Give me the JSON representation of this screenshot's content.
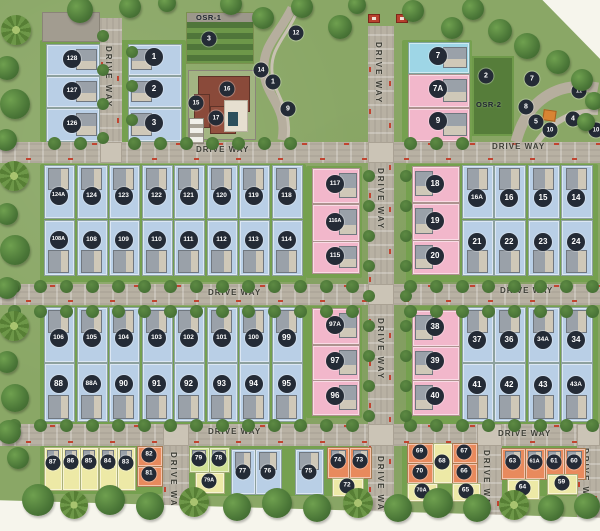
{
  "map": {
    "driveway_label": "DRIVE WAY",
    "osr1_label": "OSR-1",
    "osr2_label": "OSR-2",
    "driveways": {
      "horizontal": [
        {
          "x": 0,
          "y": 142,
          "w": 600,
          "h": 21
        },
        {
          "x": 0,
          "y": 284,
          "w": 600,
          "h": 21
        },
        {
          "x": 0,
          "y": 424,
          "w": 600,
          "h": 22
        }
      ],
      "vertical": [
        {
          "x": 100,
          "y": 18,
          "w": 22,
          "h": 125
        },
        {
          "x": 368,
          "y": 26,
          "w": 26,
          "h": 500
        },
        {
          "x": 163,
          "y": 446,
          "w": 26,
          "h": 80
        },
        {
          "x": 477,
          "y": 446,
          "w": 25,
          "h": 80
        },
        {
          "x": 577,
          "y": 446,
          "w": 23,
          "h": 75
        }
      ],
      "labels": [
        {
          "x": 196,
          "y": 145,
          "v": 0
        },
        {
          "x": 492,
          "y": 142,
          "v": 0
        },
        {
          "x": 208,
          "y": 288,
          "v": 0
        },
        {
          "x": 500,
          "y": 286,
          "v": 0
        },
        {
          "x": 208,
          "y": 427,
          "v": 0
        },
        {
          "x": 498,
          "y": 429,
          "v": 0
        },
        {
          "x": 104,
          "y": 46,
          "v": 1
        },
        {
          "x": 374,
          "y": 42,
          "v": 1
        },
        {
          "x": 376,
          "y": 168,
          "v": 1
        },
        {
          "x": 376,
          "y": 318,
          "v": 1
        },
        {
          "x": 376,
          "y": 456,
          "v": 1
        },
        {
          "x": 169,
          "y": 452,
          "v": 1
        },
        {
          "x": 482,
          "y": 450,
          "v": 1
        },
        {
          "x": 581,
          "y": 448,
          "v": 1
        }
      ]
    }
  },
  "palette": {
    "blue": "#b9cfe6",
    "cyan": "#9ed6e6",
    "pink": "#f2b7cb",
    "yellow": "#ede9a6",
    "orange": "#e88a5d",
    "green": "#cfe093",
    "circle": "#242b36",
    "road": "#b8b1a3",
    "lawn": "#567d3a",
    "red": "#c04531"
  },
  "plots": [
    {
      "label": "128",
      "x": 46,
      "y": 44,
      "w": 52,
      "h": 30,
      "c": "blue",
      "hs": "r",
      "cy": 59
    },
    {
      "label": "127",
      "x": 46,
      "y": 76,
      "w": 52,
      "h": 30,
      "c": "blue",
      "hs": "r",
      "cy": 91
    },
    {
      "label": "126",
      "x": 46,
      "y": 108,
      "w": 52,
      "h": 32,
      "c": "blue",
      "hs": "r",
      "cy": 124
    },
    {
      "label": "1",
      "x": 128,
      "y": 44,
      "w": 52,
      "h": 30,
      "c": "blue",
      "hs": "l",
      "cy": 57
    },
    {
      "label": "2",
      "x": 128,
      "y": 76,
      "w": 52,
      "h": 30,
      "c": "blue",
      "hs": "l",
      "cy": 89
    },
    {
      "label": "3",
      "x": 128,
      "y": 108,
      "w": 52,
      "h": 32,
      "c": "blue",
      "hs": "l",
      "cy": 123
    },
    {
      "label": "7",
      "x": 408,
      "y": 42,
      "w": 60,
      "h": 30,
      "c": "cyan",
      "hs": "r",
      "cy": 56
    },
    {
      "label": "7A",
      "x": 408,
      "y": 74,
      "w": 60,
      "h": 32,
      "c": "pink",
      "hs": "r",
      "cy": 89
    },
    {
      "label": "9",
      "x": 408,
      "y": 108,
      "w": 60,
      "h": 32,
      "c": "pink",
      "hs": "r",
      "cy": 121
    },
    {
      "label": "124A",
      "x": 44,
      "y": 165,
      "w": 29,
      "h": 52,
      "c": "blue",
      "hs": "t",
      "cy": 196
    },
    {
      "label": "124",
      "x": 77,
      "y": 165,
      "w": 29,
      "h": 52,
      "c": "blue",
      "hs": "t",
      "cy": 196
    },
    {
      "label": "123",
      "x": 109,
      "y": 165,
      "w": 29,
      "h": 52,
      "c": "blue",
      "hs": "t",
      "cy": 196
    },
    {
      "label": "122",
      "x": 142,
      "y": 165,
      "w": 29,
      "h": 52,
      "c": "blue",
      "hs": "t",
      "cy": 196
    },
    {
      "label": "121",
      "x": 174,
      "y": 165,
      "w": 29,
      "h": 52,
      "c": "blue",
      "hs": "t",
      "cy": 196
    },
    {
      "label": "120",
      "x": 207,
      "y": 165,
      "w": 29,
      "h": 52,
      "c": "blue",
      "hs": "t",
      "cy": 196
    },
    {
      "label": "119",
      "x": 239,
      "y": 165,
      "w": 29,
      "h": 52,
      "c": "blue",
      "hs": "t",
      "cy": 196
    },
    {
      "label": "118",
      "x": 272,
      "y": 165,
      "w": 29,
      "h": 52,
      "c": "blue",
      "hs": "t",
      "cy": 196
    },
    {
      "label": "108A",
      "x": 44,
      "y": 220,
      "w": 29,
      "h": 54,
      "c": "blue",
      "hs": "b",
      "cy": 240
    },
    {
      "label": "108",
      "x": 77,
      "y": 220,
      "w": 29,
      "h": 54,
      "c": "blue",
      "hs": "b",
      "cy": 240
    },
    {
      "label": "109",
      "x": 109,
      "y": 220,
      "w": 29,
      "h": 54,
      "c": "blue",
      "hs": "b",
      "cy": 240
    },
    {
      "label": "110",
      "x": 142,
      "y": 220,
      "w": 29,
      "h": 54,
      "c": "blue",
      "hs": "b",
      "cy": 240
    },
    {
      "label": "111",
      "x": 174,
      "y": 220,
      "w": 29,
      "h": 54,
      "c": "blue",
      "hs": "b",
      "cy": 240
    },
    {
      "label": "112",
      "x": 207,
      "y": 220,
      "w": 29,
      "h": 54,
      "c": "blue",
      "hs": "b",
      "cy": 240
    },
    {
      "label": "113",
      "x": 239,
      "y": 220,
      "w": 29,
      "h": 54,
      "c": "blue",
      "hs": "b",
      "cy": 240
    },
    {
      "label": "114",
      "x": 272,
      "y": 220,
      "w": 29,
      "h": 54,
      "c": "blue",
      "hs": "b",
      "cy": 240
    },
    {
      "label": "117",
      "x": 312,
      "y": 168,
      "w": 46,
      "h": 34,
      "c": "pink",
      "hs": "r",
      "cy": 184
    },
    {
      "label": "116A",
      "x": 312,
      "y": 204,
      "w": 46,
      "h": 36,
      "c": "pink",
      "hs": "r",
      "cy": 222
    },
    {
      "label": "115",
      "x": 312,
      "y": 241,
      "w": 46,
      "h": 31,
      "c": "pink",
      "hs": "r",
      "cy": 256
    },
    {
      "label": "18",
      "x": 412,
      "y": 166,
      "w": 46,
      "h": 35,
      "c": "pink",
      "hs": "l",
      "cy": 184
    },
    {
      "label": "19",
      "x": 412,
      "y": 203,
      "w": 46,
      "h": 36,
      "c": "pink",
      "hs": "l",
      "cy": 221
    },
    {
      "label": "20",
      "x": 412,
      "y": 240,
      "w": 46,
      "h": 33,
      "c": "pink",
      "hs": "l",
      "cy": 256
    },
    {
      "label": "16A",
      "x": 462,
      "y": 165,
      "w": 30,
      "h": 52,
      "c": "blue",
      "hs": "t",
      "cy": 198
    },
    {
      "label": "16",
      "x": 494,
      "y": 165,
      "w": 30,
      "h": 52,
      "c": "blue",
      "hs": "t",
      "cy": 198
    },
    {
      "label": "15",
      "x": 528,
      "y": 165,
      "w": 30,
      "h": 52,
      "c": "blue",
      "hs": "t",
      "cy": 198
    },
    {
      "label": "14",
      "x": 561,
      "y": 165,
      "w": 30,
      "h": 52,
      "c": "blue",
      "hs": "t",
      "cy": 198
    },
    {
      "label": "21",
      "x": 462,
      "y": 220,
      "w": 30,
      "h": 54,
      "c": "blue",
      "hs": "b",
      "cy": 242
    },
    {
      "label": "22",
      "x": 494,
      "y": 220,
      "w": 30,
      "h": 54,
      "c": "blue",
      "hs": "b",
      "cy": 242
    },
    {
      "label": "23",
      "x": 528,
      "y": 220,
      "w": 30,
      "h": 54,
      "c": "blue",
      "hs": "b",
      "cy": 242
    },
    {
      "label": "24",
      "x": 561,
      "y": 220,
      "w": 30,
      "h": 54,
      "c": "blue",
      "hs": "b",
      "cy": 242
    },
    {
      "label": "106",
      "x": 44,
      "y": 307,
      "w": 29,
      "h": 54,
      "c": "blue",
      "hs": "t",
      "cy": 338
    },
    {
      "label": "105",
      "x": 77,
      "y": 307,
      "w": 29,
      "h": 54,
      "c": "blue",
      "hs": "t",
      "cy": 338
    },
    {
      "label": "104",
      "x": 109,
      "y": 307,
      "w": 29,
      "h": 54,
      "c": "blue",
      "hs": "t",
      "cy": 338
    },
    {
      "label": "103",
      "x": 142,
      "y": 307,
      "w": 29,
      "h": 54,
      "c": "blue",
      "hs": "t",
      "cy": 338
    },
    {
      "label": "102",
      "x": 174,
      "y": 307,
      "w": 29,
      "h": 54,
      "c": "blue",
      "hs": "t",
      "cy": 338
    },
    {
      "label": "101",
      "x": 207,
      "y": 307,
      "w": 29,
      "h": 54,
      "c": "blue",
      "hs": "t",
      "cy": 338
    },
    {
      "label": "100",
      "x": 239,
      "y": 307,
      "w": 29,
      "h": 54,
      "c": "blue",
      "hs": "t",
      "cy": 338
    },
    {
      "label": "99",
      "x": 272,
      "y": 307,
      "w": 29,
      "h": 54,
      "c": "blue",
      "hs": "t",
      "cy": 338
    },
    {
      "label": "88",
      "x": 44,
      "y": 363,
      "w": 29,
      "h": 57,
      "c": "blue",
      "hs": "b",
      "cy": 384
    },
    {
      "label": "88A",
      "x": 77,
      "y": 363,
      "w": 29,
      "h": 57,
      "c": "blue",
      "hs": "b",
      "cy": 384
    },
    {
      "label": "90",
      "x": 109,
      "y": 363,
      "w": 29,
      "h": 57,
      "c": "blue",
      "hs": "b",
      "cy": 384
    },
    {
      "label": "91",
      "x": 142,
      "y": 363,
      "w": 29,
      "h": 57,
      "c": "blue",
      "hs": "b",
      "cy": 384
    },
    {
      "label": "92",
      "x": 174,
      "y": 363,
      "w": 29,
      "h": 57,
      "c": "blue",
      "hs": "b",
      "cy": 384
    },
    {
      "label": "93",
      "x": 207,
      "y": 363,
      "w": 29,
      "h": 57,
      "c": "blue",
      "hs": "b",
      "cy": 384
    },
    {
      "label": "94",
      "x": 239,
      "y": 363,
      "w": 29,
      "h": 57,
      "c": "blue",
      "hs": "b",
      "cy": 384
    },
    {
      "label": "95",
      "x": 272,
      "y": 363,
      "w": 29,
      "h": 57,
      "c": "blue",
      "hs": "b",
      "cy": 384
    },
    {
      "label": "97A",
      "x": 312,
      "y": 308,
      "w": 46,
      "h": 35,
      "c": "pink",
      "hs": "r",
      "cy": 325
    },
    {
      "label": "97",
      "x": 312,
      "y": 345,
      "w": 46,
      "h": 34,
      "c": "pink",
      "hs": "r",
      "cy": 361
    },
    {
      "label": "96",
      "x": 312,
      "y": 380,
      "w": 46,
      "h": 34,
      "c": "pink",
      "hs": "r",
      "cy": 396
    },
    {
      "label": "38",
      "x": 412,
      "y": 310,
      "w": 46,
      "h": 35,
      "c": "pink",
      "hs": "l",
      "cy": 327
    },
    {
      "label": "39",
      "x": 412,
      "y": 346,
      "w": 46,
      "h": 33,
      "c": "pink",
      "hs": "l",
      "cy": 361
    },
    {
      "label": "40",
      "x": 412,
      "y": 380,
      "w": 46,
      "h": 34,
      "c": "pink",
      "hs": "l",
      "cy": 396
    },
    {
      "label": "37",
      "x": 462,
      "y": 307,
      "w": 30,
      "h": 54,
      "c": "blue",
      "hs": "t",
      "cy": 340
    },
    {
      "label": "36",
      "x": 494,
      "y": 307,
      "w": 30,
      "h": 54,
      "c": "blue",
      "hs": "t",
      "cy": 340
    },
    {
      "label": "34A",
      "x": 528,
      "y": 307,
      "w": 30,
      "h": 54,
      "c": "blue",
      "hs": "t",
      "cy": 340
    },
    {
      "label": "34",
      "x": 561,
      "y": 307,
      "w": 30,
      "h": 54,
      "c": "blue",
      "hs": "t",
      "cy": 340
    },
    {
      "label": "41",
      "x": 462,
      "y": 363,
      "w": 30,
      "h": 57,
      "c": "blue",
      "hs": "b",
      "cy": 385
    },
    {
      "label": "42",
      "x": 494,
      "y": 363,
      "w": 30,
      "h": 57,
      "c": "blue",
      "hs": "b",
      "cy": 385
    },
    {
      "label": "43",
      "x": 528,
      "y": 363,
      "w": 30,
      "h": 57,
      "c": "blue",
      "hs": "b",
      "cy": 385
    },
    {
      "label": "43A",
      "x": 561,
      "y": 363,
      "w": 30,
      "h": 57,
      "c": "blue",
      "hs": "b",
      "cy": 385
    },
    {
      "label": "87",
      "x": 44,
      "y": 447,
      "w": 17,
      "h": 42,
      "c": "yellow",
      "hs": "t",
      "cy": 463,
      "s": 1
    },
    {
      "label": "86",
      "x": 62,
      "y": 447,
      "w": 17,
      "h": 42,
      "c": "yellow",
      "hs": "t",
      "cy": 462,
      "s": 1
    },
    {
      "label": "85",
      "x": 80,
      "y": 447,
      "w": 17,
      "h": 42,
      "c": "yellow",
      "hs": "t",
      "cy": 462,
      "s": 1
    },
    {
      "label": "84",
      "x": 99,
      "y": 447,
      "w": 17,
      "h": 42,
      "c": "yellow",
      "hs": "t",
      "cy": 462,
      "s": 1
    },
    {
      "label": "83",
      "x": 117,
      "y": 447,
      "w": 17,
      "h": 42,
      "c": "yellow",
      "hs": "t",
      "cy": 463,
      "s": 1
    },
    {
      "label": "82",
      "x": 137,
      "y": 446,
      "w": 24,
      "h": 19,
      "c": "orange",
      "hs": "n",
      "cy": 455,
      "s": 1
    },
    {
      "label": "81",
      "x": 137,
      "y": 466,
      "w": 24,
      "h": 19,
      "c": "orange",
      "hs": "n",
      "cy": 474,
      "s": 1
    },
    {
      "label": "79",
      "x": 189,
      "y": 447,
      "w": 19,
      "h": 24,
      "c": "green",
      "hs": "t",
      "cy": 459,
      "s": 1
    },
    {
      "label": "78",
      "x": 209,
      "y": 447,
      "w": 19,
      "h": 24,
      "c": "green",
      "hs": "t",
      "cy": 459,
      "s": 1
    },
    {
      "label": "79A",
      "x": 195,
      "y": 472,
      "w": 28,
      "h": 20,
      "c": "yellow",
      "hs": "n",
      "cy": 481,
      "s": 1
    },
    {
      "label": "77",
      "x": 231,
      "y": 449,
      "w": 23,
      "h": 44,
      "c": "blue",
      "hs": "t",
      "cy": 472,
      "s": 1
    },
    {
      "label": "76",
      "x": 255,
      "y": 449,
      "w": 25,
      "h": 44,
      "c": "blue",
      "hs": "t",
      "cy": 472,
      "s": 1
    },
    {
      "label": "75",
      "x": 295,
      "y": 449,
      "w": 27,
      "h": 44,
      "c": "blue",
      "hs": "t",
      "cy": 472,
      "s": 1
    },
    {
      "label": "74",
      "x": 327,
      "y": 447,
      "w": 21,
      "h": 30,
      "c": "orange",
      "hs": "t",
      "cy": 461,
      "s": 1
    },
    {
      "label": "73",
      "x": 349,
      "y": 447,
      "w": 21,
      "h": 30,
      "c": "orange",
      "hs": "t",
      "cy": 461,
      "s": 1
    },
    {
      "label": "72",
      "x": 332,
      "y": 478,
      "w": 30,
      "h": 17,
      "c": "yellow",
      "hs": "n",
      "cy": 486,
      "s": 1
    },
    {
      "label": "69",
      "x": 407,
      "y": 443,
      "w": 25,
      "h": 19,
      "c": "orange",
      "hs": "n",
      "cy": 452,
      "s": 1
    },
    {
      "label": "70",
      "x": 407,
      "y": 463,
      "w": 25,
      "h": 19,
      "c": "orange",
      "hs": "n",
      "cy": 472,
      "s": 1
    },
    {
      "label": "70A",
      "x": 407,
      "y": 483,
      "w": 29,
      "h": 17,
      "c": "yellow",
      "hs": "n",
      "cy": 491,
      "s": 1
    },
    {
      "label": "68",
      "x": 433,
      "y": 443,
      "w": 18,
      "h": 39,
      "c": "yellow",
      "hs": "n",
      "cy": 462,
      "s": 1
    },
    {
      "label": "67",
      "x": 452,
      "y": 443,
      "w": 24,
      "h": 19,
      "c": "orange",
      "hs": "n",
      "cy": 452,
      "s": 1
    },
    {
      "label": "66",
      "x": 452,
      "y": 463,
      "w": 24,
      "h": 19,
      "c": "orange",
      "hs": "n",
      "cy": 472,
      "s": 1
    },
    {
      "label": "65",
      "x": 452,
      "y": 483,
      "w": 27,
      "h": 17,
      "c": "yellow",
      "hs": "n",
      "cy": 491,
      "s": 1
    },
    {
      "label": "63",
      "x": 501,
      "y": 448,
      "w": 23,
      "h": 30,
      "c": "orange",
      "hs": "t",
      "cy": 462,
      "s": 1
    },
    {
      "label": "61A",
      "x": 525,
      "y": 448,
      "w": 19,
      "h": 30,
      "c": "orange",
      "hs": "t",
      "cy": 462,
      "s": 1
    },
    {
      "label": "61",
      "x": 545,
      "y": 448,
      "w": 18,
      "h": 30,
      "c": "orange",
      "hs": "t",
      "cy": 462,
      "s": 1
    },
    {
      "label": "60",
      "x": 564,
      "y": 448,
      "w": 20,
      "h": 30,
      "c": "orange",
      "hs": "t",
      "cy": 462,
      "s": 1
    },
    {
      "label": "64",
      "x": 507,
      "y": 479,
      "w": 31,
      "h": 19,
      "c": "yellow",
      "hs": "n",
      "cy": 488,
      "s": 1
    },
    {
      "label": "59",
      "x": 547,
      "y": 474,
      "w": 29,
      "h": 19,
      "c": "yellow",
      "hs": "n",
      "cy": 483,
      "s": 1
    }
  ],
  "amenities": [
    {
      "label": "3",
      "x": 209,
      "y": 39
    },
    {
      "label": "12",
      "x": 296,
      "y": 33
    },
    {
      "label": "14",
      "x": 261,
      "y": 70
    },
    {
      "label": "1",
      "x": 273,
      "y": 82
    },
    {
      "label": "9",
      "x": 288,
      "y": 109
    },
    {
      "label": "15",
      "x": 196,
      "y": 103
    },
    {
      "label": "16",
      "x": 227,
      "y": 89
    },
    {
      "label": "17",
      "x": 216,
      "y": 118
    },
    {
      "label": "2",
      "x": 486,
      "y": 76
    },
    {
      "label": "7",
      "x": 532,
      "y": 79
    },
    {
      "label": "11",
      "x": 579,
      "y": 91
    },
    {
      "label": "8",
      "x": 526,
      "y": 107
    },
    {
      "label": "5",
      "x": 536,
      "y": 122
    },
    {
      "label": "4",
      "x": 573,
      "y": 119
    },
    {
      "label": "10",
      "x": 550,
      "y": 130
    },
    {
      "label": "10",
      "x": 596,
      "y": 130
    }
  ]
}
